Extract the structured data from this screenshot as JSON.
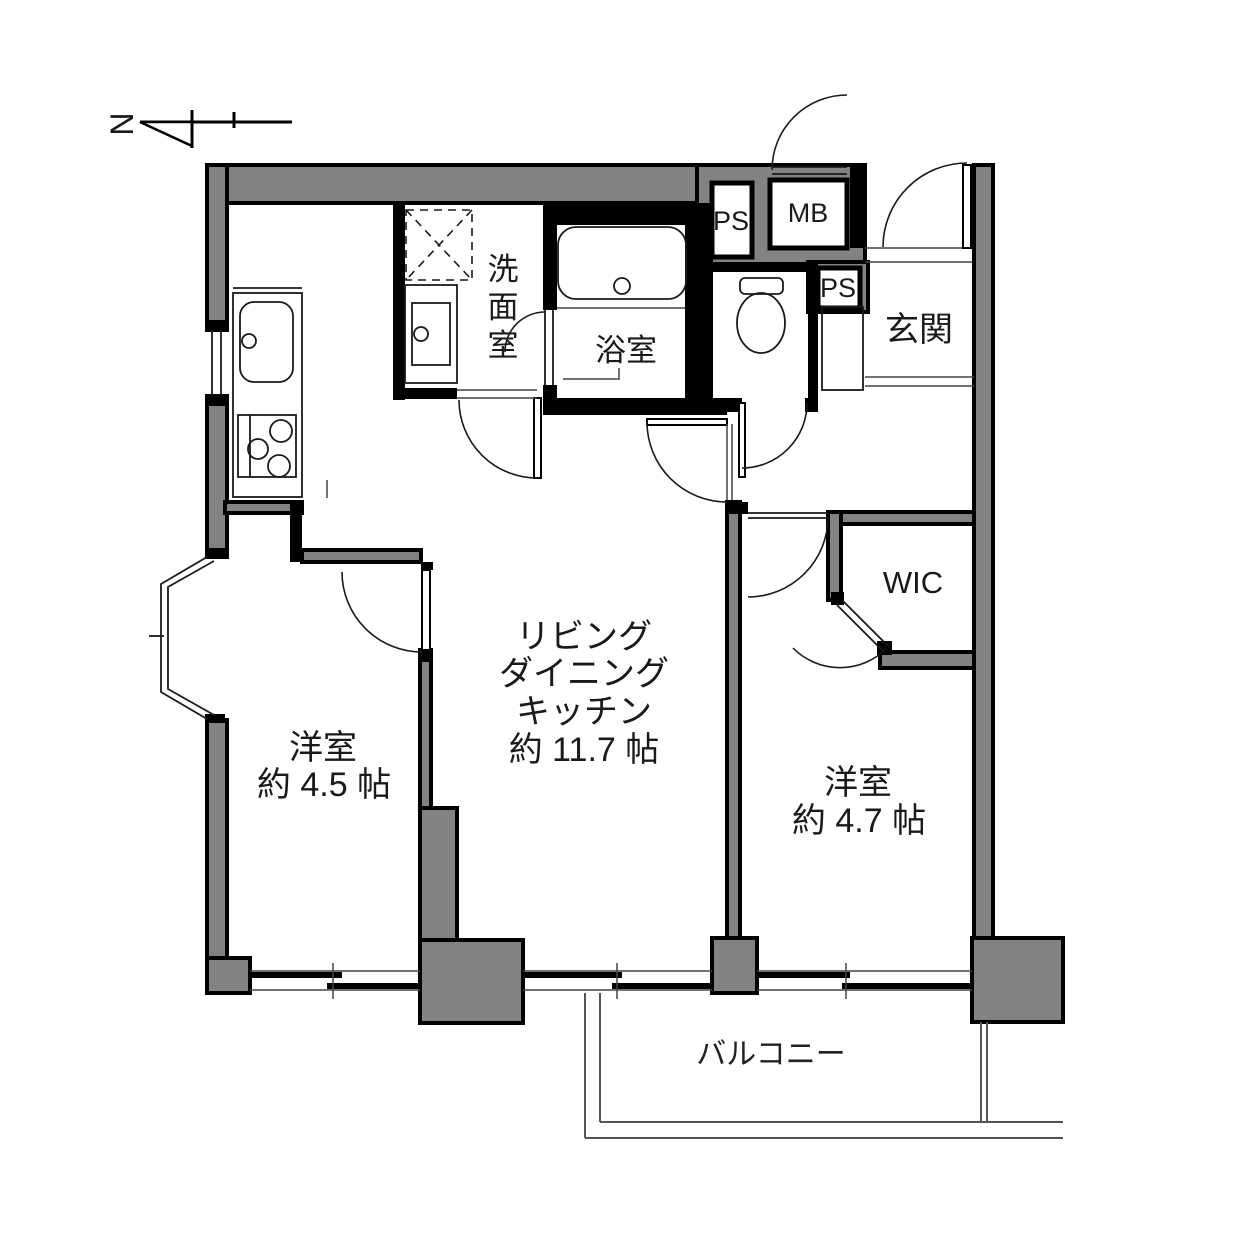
{
  "title": "2LDK apartment floor plan",
  "compass": {
    "north_label": "N"
  },
  "colors": {
    "wall_fill": "#828282",
    "outline": "#000000",
    "background": "#ffffff"
  },
  "rooms": {
    "ldk": {
      "lines": [
        "リビング",
        "ダイニング",
        "キッチン",
        "約 11.7 帖"
      ]
    },
    "bedroom_west": {
      "name": "洋室",
      "size": "約 4.5 帖"
    },
    "bedroom_east": {
      "name": "洋室",
      "size": "約 4.7 帖"
    },
    "entrance": {
      "name": "玄関"
    },
    "washroom": {
      "chars": [
        "洗",
        "面",
        "室"
      ]
    },
    "bathroom": {
      "name": "浴室"
    },
    "wic": {
      "name": "WIC"
    },
    "balcony": {
      "name": "バルコニー"
    }
  },
  "service": {
    "ps_top": "PS",
    "mb": "MB",
    "ps_side": "PS"
  }
}
